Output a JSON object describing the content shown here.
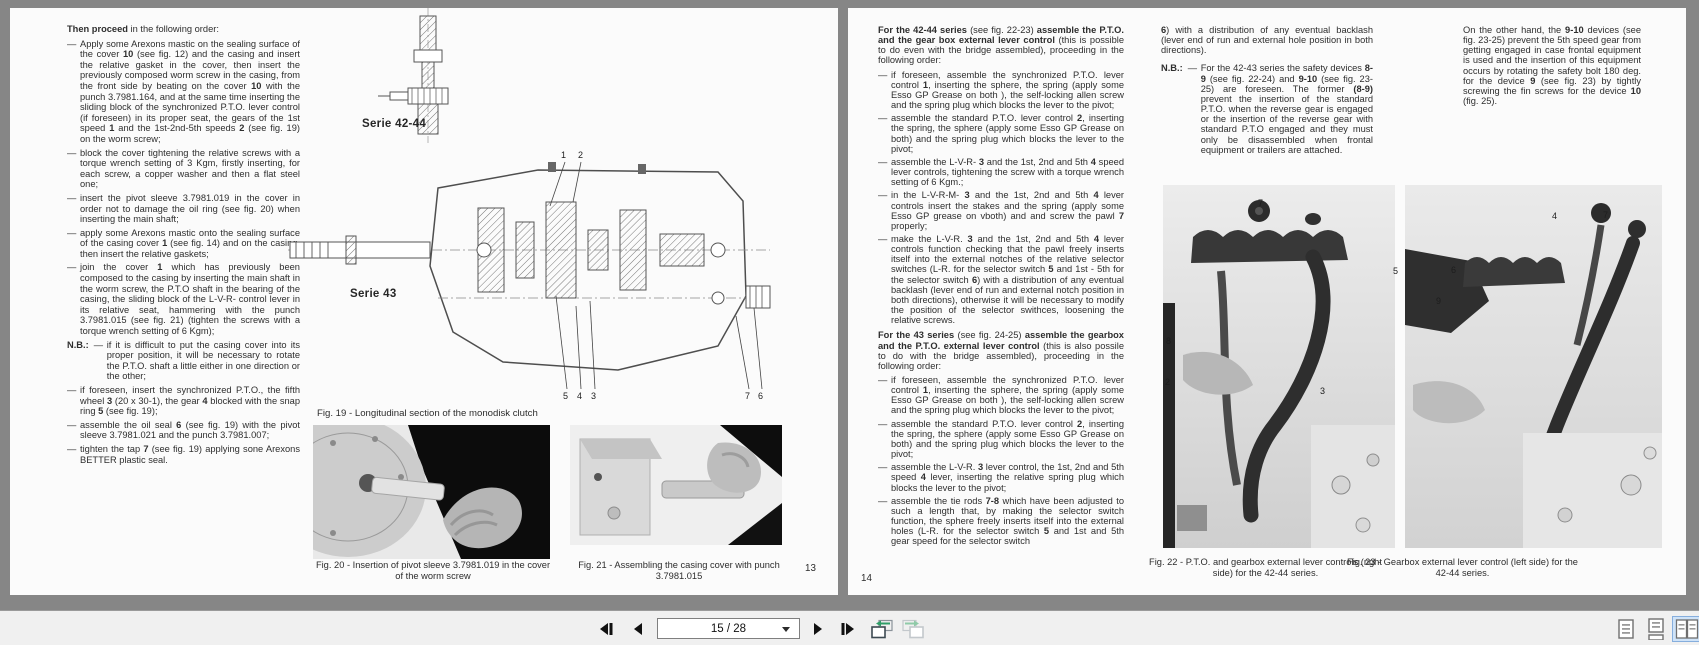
{
  "colors": {
    "backdrop": "#868686",
    "page": "#fbfbfb",
    "toolbar": "#f0f0f0",
    "selection_bg": "#cfe3f8",
    "selection_border": "#86aedd",
    "history_green": "#2f9e68"
  },
  "toolbar": {
    "page_indicator": "15 / 28",
    "icons": [
      "first-page-icon",
      "previous-page-icon",
      "page-selector-dropdown-icon",
      "next-page-icon",
      "last-page-icon",
      "previous-view-icon",
      "next-view-icon",
      "single-page-view-icon",
      "continuous-view-icon",
      "facing-pages-view-icon"
    ]
  },
  "left_page": {
    "page_number": "13",
    "intro": [
      [
        "Then proceed",
        1
      ],
      [
        " in the following order:",
        0
      ]
    ],
    "items": [
      {
        "marker": "—",
        "segs": [
          [
            "Apply some Arexons mastic on the sealing surface of the cover ",
            0
          ],
          [
            "10",
            1
          ],
          [
            " (see fig. 12) and the casing and insert the relative gasket in the cover, then insert the previously composed worm screw in the casing, from the front side by beating on the cover ",
            0
          ],
          [
            "10",
            1
          ],
          [
            " with the punch 3.7981.164, and at the same time inserting the sliding block of the synchronized P.T.O. lever control (if foreseen) in its proper seat, the gears of the 1st speed ",
            0
          ],
          [
            "1",
            1
          ],
          [
            " and the 1st-2nd-5th speeds ",
            0
          ],
          [
            "2",
            1
          ],
          [
            " (see fig. 19) on the worm screw;",
            0
          ]
        ]
      },
      {
        "marker": "—",
        "segs": [
          [
            "block the cover tightening the relative screws with a torque wrench setting of 3 Kgm, firstly inserting, for each screw, a copper washer and then a flat steel one;",
            0
          ]
        ]
      },
      {
        "marker": "—",
        "segs": [
          [
            "insert the pivot sleeve 3.7981.019 in the cover in order not to damage the oil ring (see fig. 20) when inserting the main shaft;",
            0
          ]
        ]
      },
      {
        "marker": "—",
        "segs": [
          [
            "apply some Arexons mastic onto the sealing surface of the casing cover ",
            0
          ],
          [
            "1",
            1
          ],
          [
            " (see fig. 14) and on the casing, then insert the relative gaskets;",
            0
          ]
        ]
      },
      {
        "marker": "—",
        "segs": [
          [
            "join the cover ",
            0
          ],
          [
            "1",
            1
          ],
          [
            " which has previously been composed to the casing by inserting the main shaft in the worm screw, the P.T.O shaft in the bearing of the casing, the sliding block of the L-V-R- control lever in its relative seat, hammering with the punch 3.7981.015 (see fig. 21) (tighten the screws with a torque wrench setting of 6 Kgm);",
            0
          ]
        ]
      },
      {
        "marker": "—",
        "label": "N.B.:",
        "segs": [
          [
            "if it is difficult to put the casing cover into its proper position, it will be necessary to rotate the P.T.O. shaft a little either in one direction or the other;",
            0
          ]
        ]
      },
      {
        "marker": "—",
        "segs": [
          [
            "if foreseen, insert the synchronized P.T.O., the fifth wheel ",
            0
          ],
          [
            "3",
            1
          ],
          [
            " (20 x 30-1), the gear ",
            0
          ],
          [
            "4",
            1
          ],
          [
            " blocked with the snap ring ",
            0
          ],
          [
            "5",
            1
          ],
          [
            " (see fig. 19);",
            0
          ]
        ]
      },
      {
        "marker": "—",
        "segs": [
          [
            "assemble the oil seal ",
            0
          ],
          [
            "6",
            1
          ],
          [
            " (see fig. 19) with the pivot sleeve 3.7981.021 and the punch 3.7981.007;",
            0
          ]
        ]
      },
      {
        "marker": "—",
        "segs": [
          [
            "tighten the tap ",
            0
          ],
          [
            "7",
            1
          ],
          [
            " (see fig. 19) applying sone Arexons BETTER plastic seal.",
            0
          ]
        ]
      }
    ],
    "serie4244_label": "Serie 42-44",
    "serie43_label": "Serie 43",
    "fig19_callouts": {
      "top": [
        "1",
        "2"
      ],
      "bottom": [
        "5",
        "4",
        "3"
      ],
      "right": [
        "7",
        "6"
      ]
    },
    "fig19_caption": "Fig. 19 - Longitudinal section of the monodisk clutch",
    "fig20_caption": "Fig. 20 - Insertion of pivot sleeve 3.7981.019 in the cover of the worm screw",
    "fig21_caption": "Fig. 21 - Assembling the casing cover with punch 3.7981.015"
  },
  "right_page": {
    "page_number": "14",
    "col1": {
      "intro1": [
        [
          "For the 42-44 series",
          1
        ],
        [
          " (see fig. 22-23) ",
          0
        ],
        [
          "assemble the P.T.O. and the gear box external lever control",
          1
        ],
        [
          " (this is possible to do even with the bridge assembled), proceeding in the following order:",
          0
        ]
      ],
      "items1": [
        {
          "marker": "—",
          "segs": [
            [
              "if foreseen, assemble the synchronized P.T.O. lever control ",
              0
            ],
            [
              "1",
              1
            ],
            [
              ", inserting the sphere, the spring (apply some Esso GP Grease on both ), the self-locking allen screw and the spring plug which blocks the lever to the pivot;",
              0
            ]
          ]
        },
        {
          "marker": "—",
          "segs": [
            [
              "assemble the standard P.T.O. lever control ",
              0
            ],
            [
              "2",
              1
            ],
            [
              ", inserting the spring, the sphere (apply some Esso GP Grease on both) and the spring plug which blocks the lever to the pivot;",
              0
            ]
          ]
        },
        {
          "marker": "—",
          "segs": [
            [
              "assemble the L-V-R- ",
              0
            ],
            [
              "3",
              1
            ],
            [
              " and the 1st, 2nd and 5th ",
              0
            ],
            [
              "4",
              1
            ],
            [
              " speed lever controls, tightening the screw with a torque wrench setting of 6 Kgm.;",
              0
            ]
          ]
        },
        {
          "marker": "—",
          "segs": [
            [
              "in the L-V-R-M- ",
              0
            ],
            [
              "3",
              1
            ],
            [
              " and the 1st, 2nd and 5th ",
              0
            ],
            [
              "4",
              1
            ],
            [
              " lever controls insert the stakes and the spring (apply some Esso GP grease on vboth) and and screw the pawl ",
              0
            ],
            [
              "7",
              1
            ],
            [
              " properly;",
              0
            ]
          ]
        },
        {
          "marker": "—",
          "segs": [
            [
              "make the L-V-R. ",
              0
            ],
            [
              "3",
              1
            ],
            [
              " and the 1st, 2nd and 5th ",
              0
            ],
            [
              "4",
              1
            ],
            [
              " lever controls function checking that the pawl freely inserts itself into the external notches of the relative selector switches (L-R. for the selector switch ",
              0
            ],
            [
              "5",
              1
            ],
            [
              " and 1st - 5th for the selector switch ",
              0
            ],
            [
              "6",
              1
            ],
            [
              ") with a distribution of any eventual backlash (lever end of run and external notch position in both directions), otherwise it will be necessary to modify the position of the selector swithces, loosening the relative screws.",
              0
            ]
          ]
        }
      ],
      "intro2": [
        [
          "For the 43 series",
          1
        ],
        [
          " (see fig. 24-25) ",
          0
        ],
        [
          "assemble the gearbox and the P.T.O. external lever control",
          1
        ],
        [
          " (this is also possile to do with the bridge assembled), proceeding in the following order:",
          0
        ]
      ],
      "items2": [
        {
          "marker": "—",
          "segs": [
            [
              "if foreseen, assemble the synchronized P.T.O. lever control ",
              0
            ],
            [
              "1",
              1
            ],
            [
              ", inserting the sphere, the spring (apply some Esso GP Grease on both ), the self-locking allen screw and the spring plug which blocks the lever to the pivot;",
              0
            ]
          ]
        },
        {
          "marker": "—",
          "segs": [
            [
              "assemble the standard P.T.O. lever control ",
              0
            ],
            [
              "2",
              1
            ],
            [
              ", inserting the spring, the sphere (apply some Esso GP Grease on both) and the spring plug which blocks the lever to the pivot;",
              0
            ]
          ]
        },
        {
          "marker": "—",
          "segs": [
            [
              "assemble the L-V-R. ",
              0
            ],
            [
              "3",
              1
            ],
            [
              " lever control, the 1st, 2nd and 5th speed ",
              0
            ],
            [
              "4",
              1
            ],
            [
              " lever, inserting the relative spring plug which blocks the lever to the pivot;",
              0
            ]
          ]
        },
        {
          "marker": "—",
          "segs": [
            [
              "assemble the tie rods ",
              0
            ],
            [
              "7-8",
              1
            ],
            [
              " which have been adjusted to such a length that, by making the selector switch function, the sphere freely inserts itself into the external holes (L-R. for the selector switch ",
              0
            ],
            [
              "5",
              1
            ],
            [
              " and 1st and 5th gear speed for the selector switch",
              0
            ]
          ]
        }
      ]
    },
    "col2": {
      "cont": [
        [
          "6",
          1
        ],
        [
          ") with a distribution of any eventual backlash (lever end of run and external hole position in both directions).",
          0
        ]
      ],
      "nb_items": [
        {
          "marker": "—",
          "label": "N.B.:",
          "segs": [
            [
              "For the 42-43 series the safety devices ",
              0
            ],
            [
              "8-9",
              1
            ],
            [
              " (see fig. 22-24) and ",
              0
            ],
            [
              "9-10",
              1
            ],
            [
              " (see fig. 23-25) are foreseen. The former ",
              0
            ],
            [
              "(8-9)",
              1
            ],
            [
              " prevent the insertion of the standard P.T.O. when the reverse gear is engaged or the insertion of the reverse gear with standard P.T.O engaged and they must only be disassembled when frontal equipment or trailers are attached.",
              0
            ]
          ]
        }
      ]
    },
    "col3": [
      [
        "On the other hand, the ",
        0
      ],
      [
        "9-10",
        1
      ],
      [
        " devices (see fig. 23-25) prevent the 5th speed gear from getting engaged in case frontal equipment is used and the insertion of this equipment occurs by rotating the safety bolt 180 deg. for the device ",
        0
      ],
      [
        "9",
        1
      ],
      [
        " (see fig. 23) by tightly screwing the fin screws for the device ",
        0
      ],
      [
        "10",
        1
      ],
      [
        " (fig. 25).",
        0
      ]
    ],
    "fig22_callouts": [
      "7",
      "5",
      "8",
      "2",
      "3"
    ],
    "fig23_callouts": [
      "6",
      "9",
      "4",
      "7"
    ],
    "fig22_caption": "Fig. 22 - P.T.O. and gearbox external lever controls (right side) for the 42-44 series.",
    "fig23_caption": "Fig. 23 - Gearbox external lever control (left side) for the 42-44 series."
  }
}
